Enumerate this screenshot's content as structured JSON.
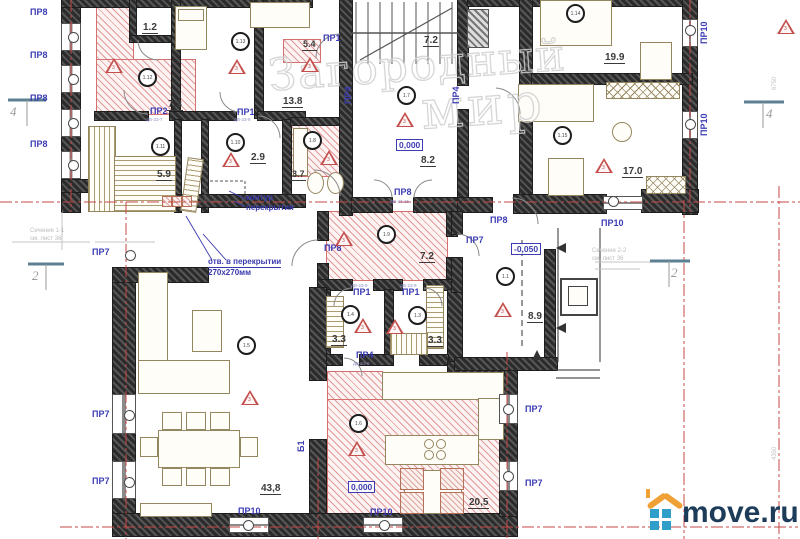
{
  "watermark": {
    "line1": "Загородный",
    "line2": "мир"
  },
  "brand": {
    "name": "move.ru"
  },
  "axes": {
    "left4": "4",
    "right4": "4",
    "left2": "2",
    "right2": "2"
  },
  "doors": [
    "ПР8",
    "ПР8",
    "ПР8",
    "ПР8",
    "ПР2",
    "ПР1",
    "ПР1",
    "ПР4",
    "ПР4",
    "ПР8",
    "ПР8",
    "ПР7",
    "ПР8",
    "ПР7",
    "ПР7",
    "ПР7",
    "ПР7",
    "ПР7",
    "ПР10",
    "ПР10",
    "ПР10",
    "ПР10",
    "ПР10",
    "ПР1",
    "ПР1",
    "ПР4",
    "Б1"
  ],
  "areas": [
    "1.2",
    "5.4",
    "7.3",
    "13.8",
    "7.2",
    "19.9",
    "2.9",
    "3.7",
    "5.9",
    "8.2",
    "17.0",
    "7.2",
    "3.3",
    "3.3",
    "8.9",
    "43,8",
    "20,5"
  ],
  "rooms": [
    "1.13",
    "1.12",
    "1.8",
    "1.11",
    "1.10",
    "1.7",
    "1.14",
    "1.15",
    "1.9",
    "1.4",
    "1.3",
    "1.1",
    "1.5",
    "1.6"
  ],
  "tri_num": "3",
  "elevations": [
    "0,000",
    "-0,050",
    "0,000"
  ],
  "codes": [
    "ДВ-23-7",
    "ДВ-23-9",
    "ДВ-23-15",
    "ДВ-23-9",
    "ДВ-23-9",
    "ДВ-23-9"
  ],
  "annotations": {
    "kontur_line1": "контур",
    "kontur_line2": "перекрытия",
    "otv_line1": "отв. в перекрытии",
    "otv_line2": "270х270мм",
    "sec1_line1": "Сечение 1-1",
    "sec1_line2": "см. лист 36",
    "sec2_line1": "Сечение 2-2",
    "sec2_line2": "см. лист 36",
    "dim_right_top": "6750",
    "dim_right_bottom": "4350"
  }
}
